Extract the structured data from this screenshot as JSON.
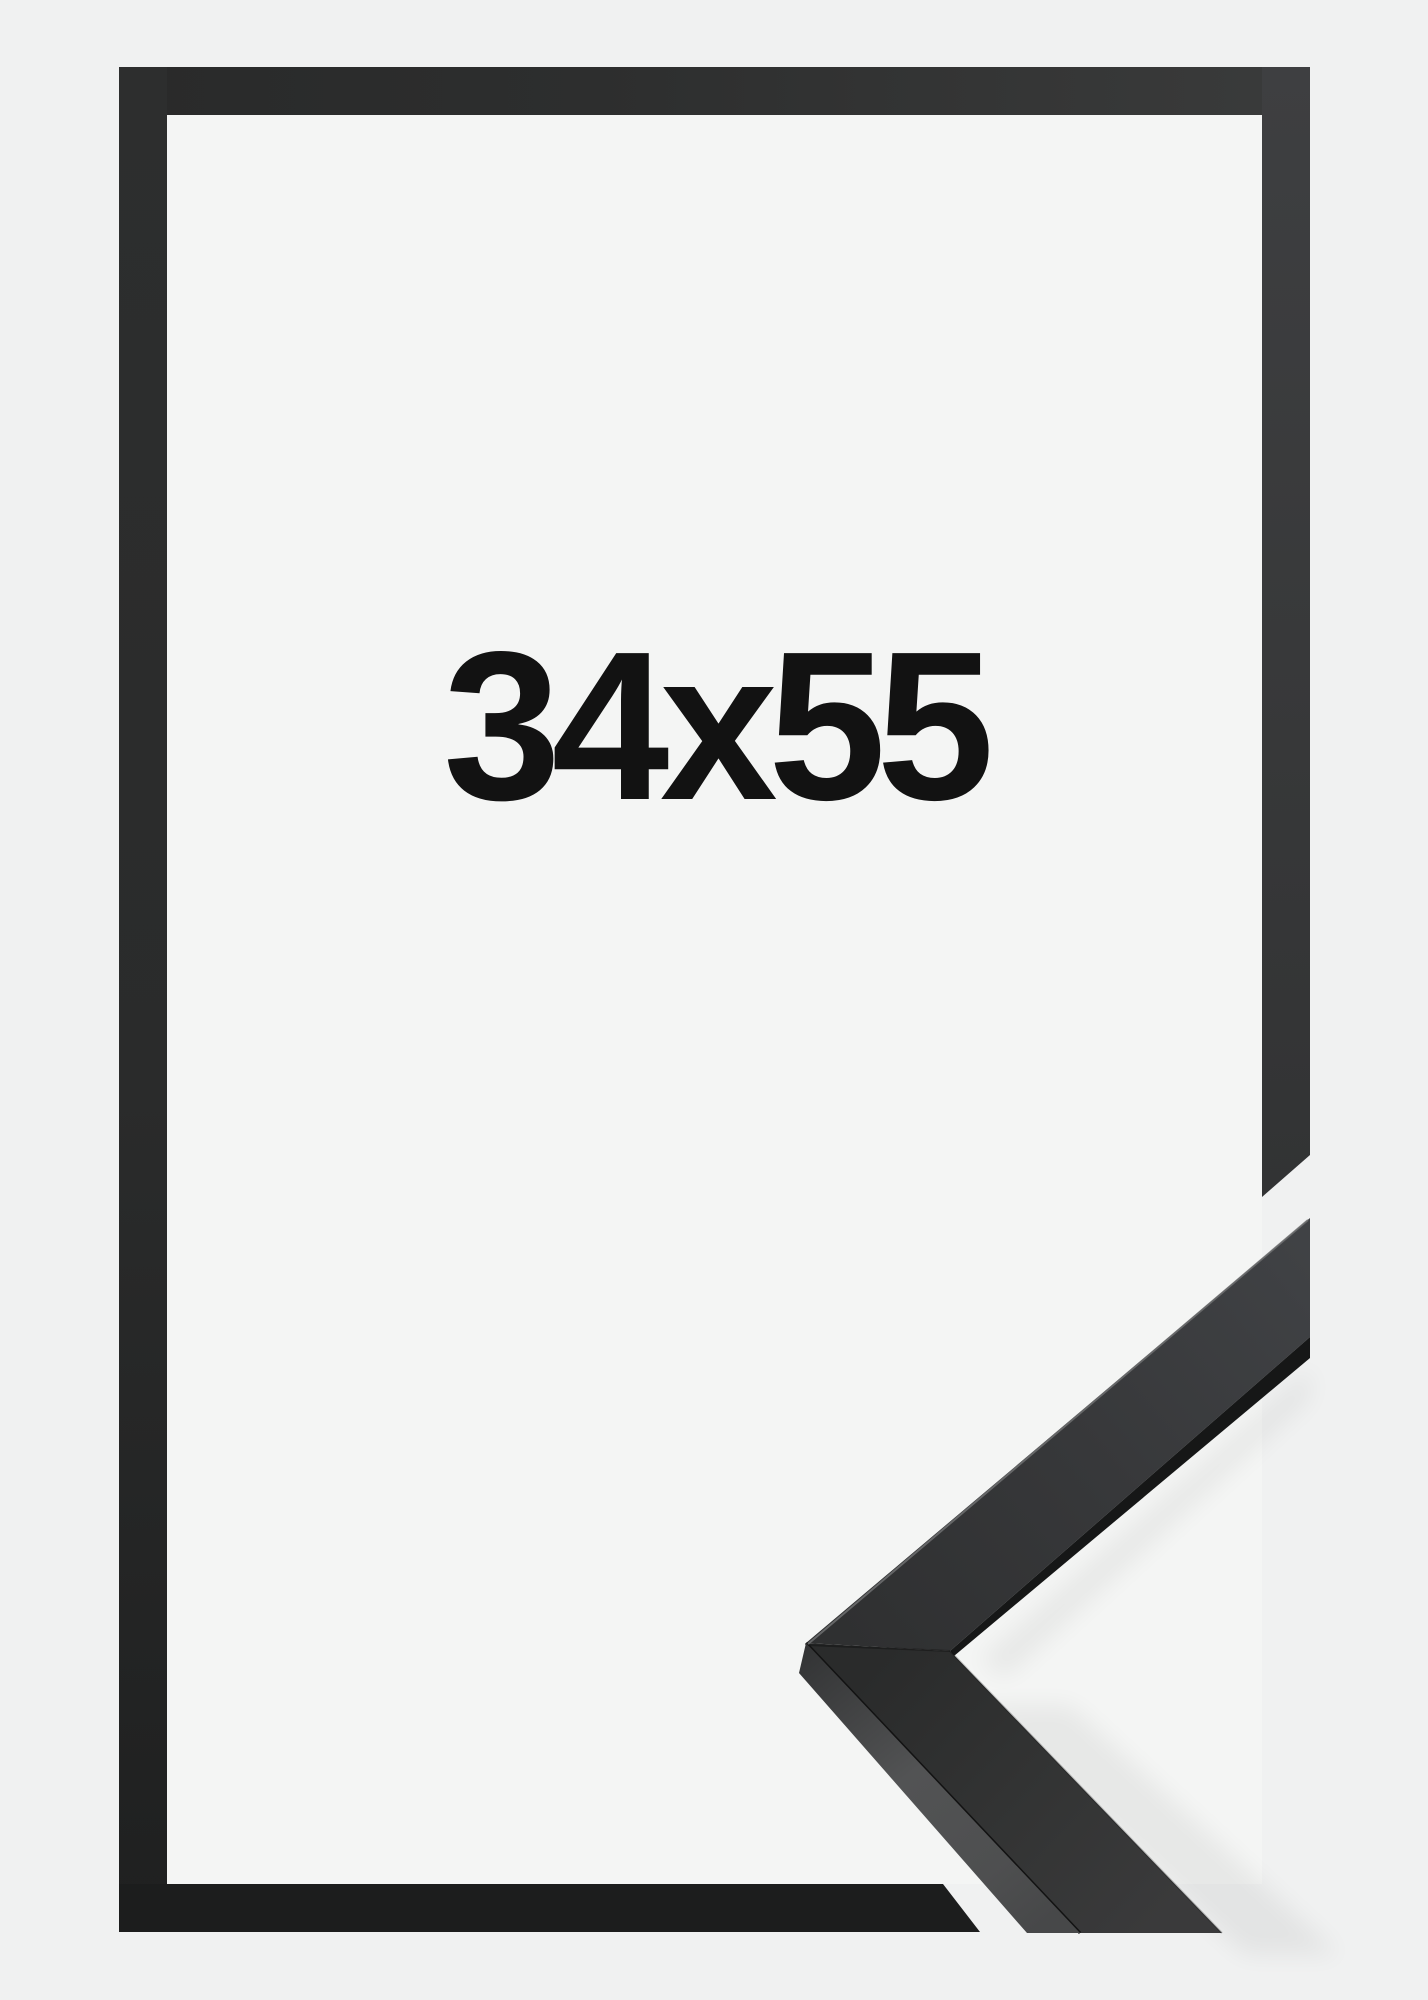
{
  "label": {
    "text": "34x55"
  },
  "colors": {
    "background": "#f0f1f1",
    "inner_background": "#f4f5f4",
    "frame_dark": "#2c2d2d",
    "frame_bottom": "#1c1d1d",
    "label_color": "#121212",
    "moulding_face": "#3a3b3d",
    "moulding_side": "#505152",
    "moulding_edge": "#161717"
  }
}
